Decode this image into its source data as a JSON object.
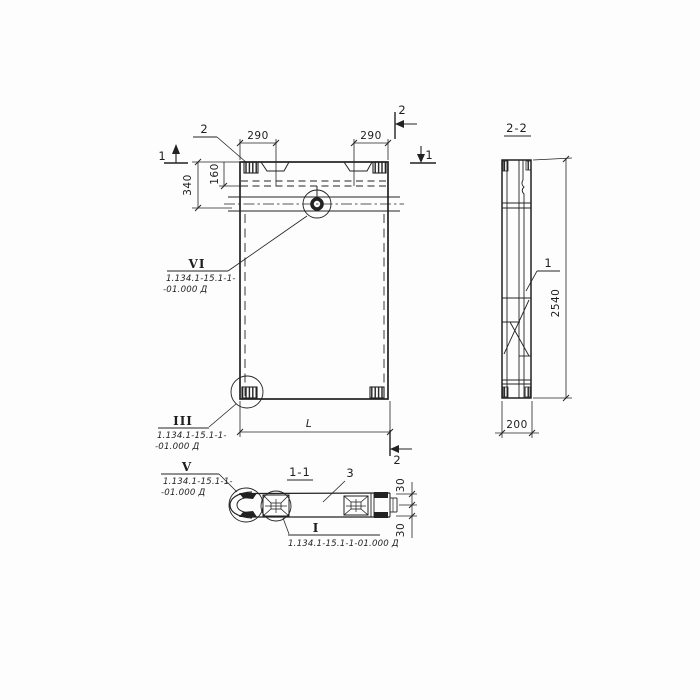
{
  "colors": {
    "ink": "#222222",
    "paper": "#fdfdfd"
  },
  "plan_view": {
    "loop_callout_label": "2",
    "dims": {
      "left_290": "290",
      "right_290": "290",
      "height_340": "340",
      "height_160": "160",
      "length_L": "L"
    },
    "cut_markers": {
      "one_left": "1",
      "one_right": "1",
      "two_top": "2",
      "two_bottom": "2"
    },
    "detail_vi": {
      "numeral": "VI",
      "doc1": "1.134.1-15.1-1-",
      "doc2": "-01.000 Д"
    },
    "detail_iii": {
      "numeral": "III",
      "doc1": "1.134.1-15.1-1-",
      "doc2": "-01.000 Д"
    }
  },
  "section_22": {
    "title": "2-2",
    "part_label": "1",
    "dims": {
      "height_2540": "2540",
      "width_200": "200"
    }
  },
  "section_11": {
    "title": "1-1",
    "part_label": "3",
    "dims": {
      "top_30": "30",
      "bottom_30": "30"
    },
    "detail_i": {
      "numeral": "I",
      "doc": "1.134.1-15.1-1-01.000 Д"
    },
    "detail_v": {
      "numeral": "V",
      "doc1": "1.134.1-15.1-1-",
      "doc2": "-01.000 Д"
    }
  }
}
